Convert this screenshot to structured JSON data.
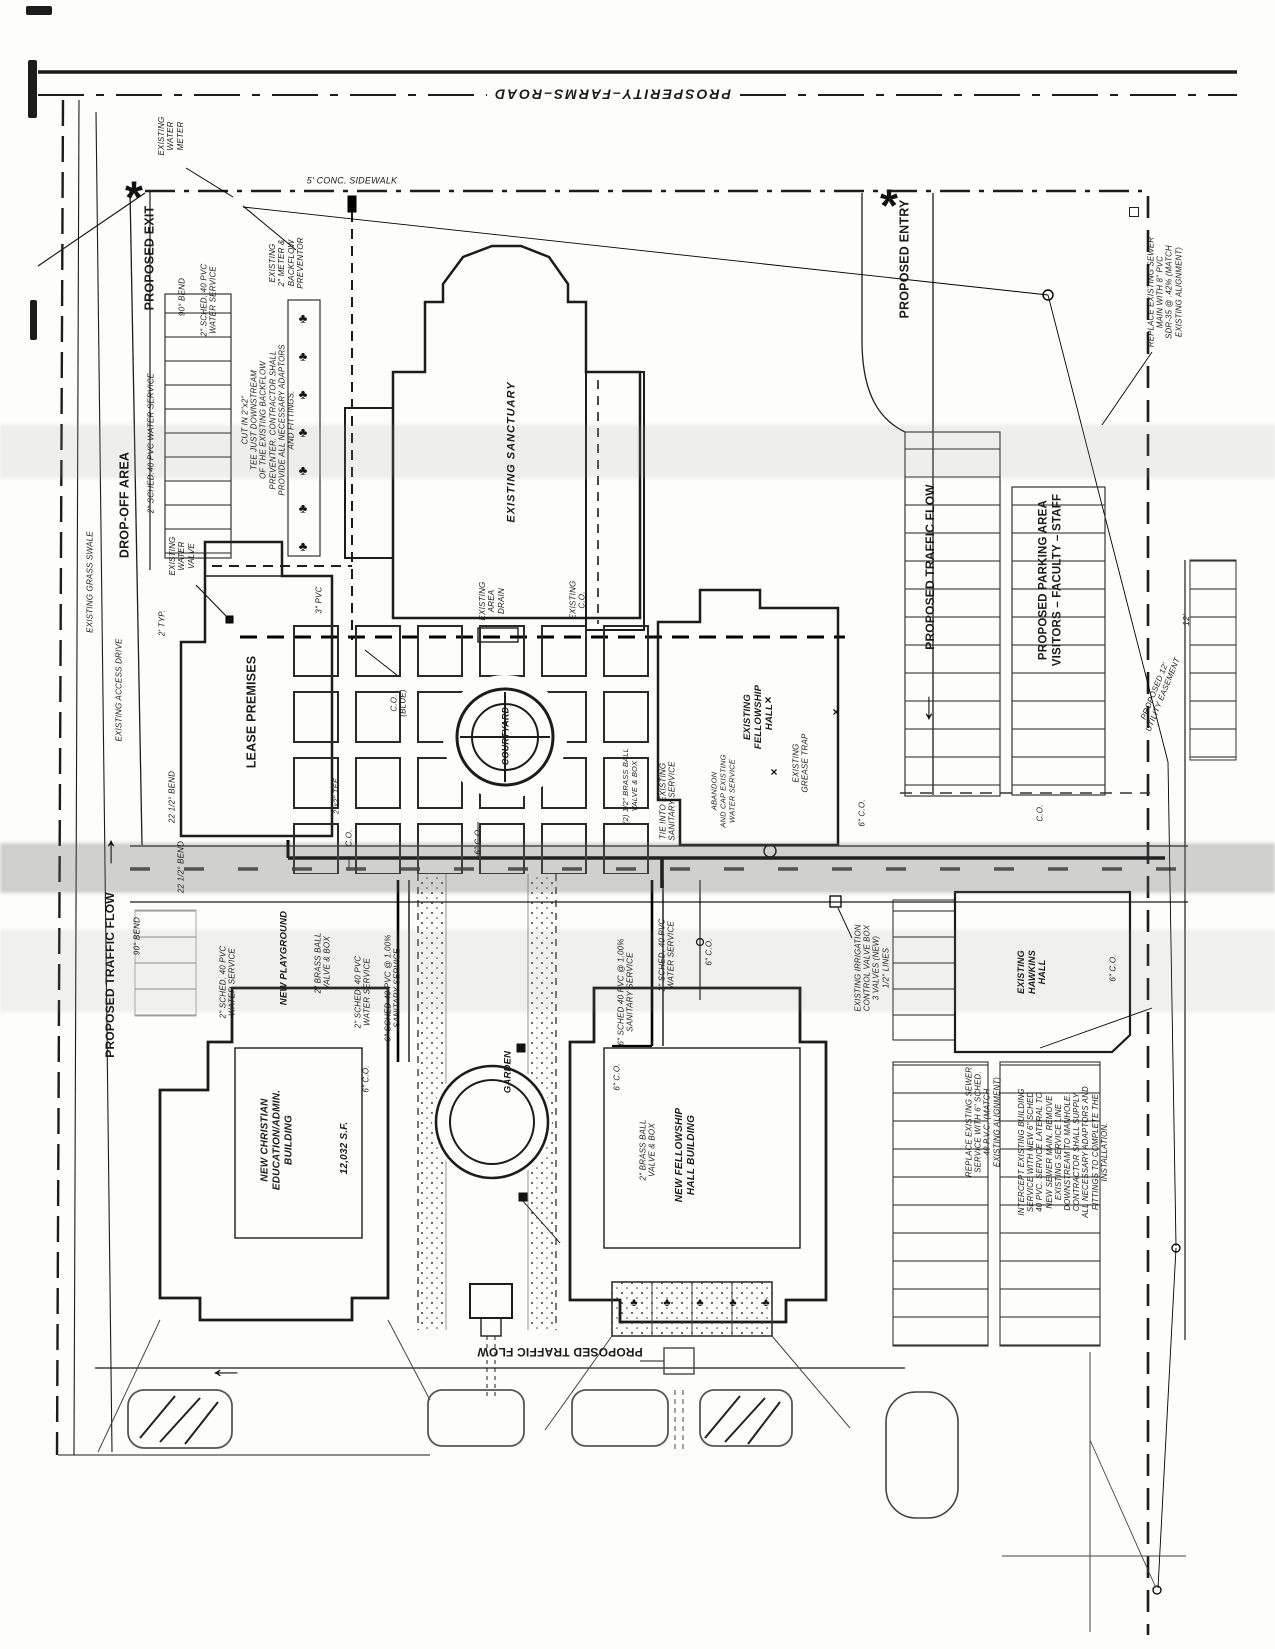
{
  "page": {
    "background": "#fdfdfb",
    "ink": "#1c1c1c",
    "faint_line": "#6b6b6b"
  },
  "road": {
    "name": "PROSPERITY–FARMS–ROAD"
  },
  "labels": [
    {
      "n": "road-name",
      "t": "PROSPERITY–FARMS–ROAD",
      "x": 612,
      "y": 94,
      "r": 180,
      "s": 14,
      "b": 1,
      "i": 1,
      "ls": 2,
      "bg": 1
    },
    {
      "n": "sidewalk-label",
      "t": "5' CONC. SIDEWALK",
      "x": 352,
      "y": 181,
      "r": 0,
      "s": 9,
      "i": 1
    },
    {
      "n": "existing-water-meter-label",
      "t": "EXISTING\nWATER\nMETER",
      "x": 171,
      "y": 136,
      "r": -90,
      "s": 8,
      "i": 1
    },
    {
      "n": "proposed-exit-label",
      "t": "PROPOSED EXIT",
      "x": 150,
      "y": 258,
      "r": -90,
      "s": 12.5,
      "b": 1
    },
    {
      "n": "bend-90-label-top",
      "t": "90° BEND",
      "x": 182,
      "y": 297,
      "r": -90,
      "s": 8,
      "i": 1
    },
    {
      "n": "water-service-label-top",
      "t": "2\" SCHED. 40 PVC\nWATER SERVICE",
      "x": 209,
      "y": 300,
      "r": -90,
      "s": 8,
      "i": 1
    },
    {
      "n": "meter-backflow-label",
      "t": "EXISTING\n2\" METER &\nBACKFLOW\nPREVENTOR",
      "x": 287,
      "y": 263,
      "r": -90,
      "s": 8,
      "i": 1
    },
    {
      "n": "note-cut-in-tee",
      "t": "CUT IN 2\"x2\"\nTEE JUST DOWNSTREAM\nOF THE EXISTING BACKFLOW\nPREVENTER. CONTRACTOR SHALL\nPROVIDE ALL NECESSARY ADAPTORS\nAND FITTINGS.",
      "x": 268,
      "y": 420,
      "r": -90,
      "s": 7.8,
      "i": 1
    },
    {
      "n": "existing-sanctuary-label",
      "t": "EXISTING SANCTUARY",
      "x": 512,
      "y": 452,
      "r": -90,
      "s": 11,
      "b": 1,
      "i": 1,
      "ls": 1
    },
    {
      "n": "existing-area-drain-label",
      "t": "EXISTING\nAREA\nDRAIN",
      "x": 492,
      "y": 601,
      "r": -90,
      "s": 8,
      "i": 1
    },
    {
      "n": "existing-co-label",
      "t": "EXISTING\nC.O.",
      "x": 578,
      "y": 600,
      "r": -90,
      "s": 8,
      "i": 1
    },
    {
      "n": "drop-off-area-label",
      "t": "DROP-OFF AREA",
      "x": 125,
      "y": 505,
      "r": -90,
      "s": 12.5,
      "b": 1
    },
    {
      "n": "water-service-label-left",
      "t": "2\" SCHED.40 PVC WATER SERVICE",
      "x": 151,
      "y": 443,
      "r": -90,
      "s": 8,
      "i": 1
    },
    {
      "n": "existing-grass-swale-label",
      "t": "EXISTING GRASS SWALE",
      "x": 90,
      "y": 582,
      "r": -90,
      "s": 8,
      "i": 1
    },
    {
      "n": "existing-access-drive-label",
      "t": "EXISTING ACCESS DRIVE",
      "x": 119,
      "y": 690,
      "r": -90,
      "s": 8,
      "i": 1
    },
    {
      "n": "existing-water-valve-label",
      "t": "EXISTING\nWATER\nVALVE",
      "x": 182,
      "y": 556,
      "r": -90,
      "s": 8,
      "i": 1
    },
    {
      "n": "typ-dim-label",
      "t": "2' TYP.",
      "x": 162,
      "y": 623,
      "r": -90,
      "s": 8,
      "i": 1
    },
    {
      "n": "lease-premises-label",
      "t": "LEASE PREMISES",
      "x": 252,
      "y": 712,
      "r": -90,
      "s": 12.5,
      "b": 1
    },
    {
      "n": "pvc-3in-label",
      "t": "3\" PVC",
      "x": 319,
      "y": 600,
      "r": -90,
      "s": 8,
      "i": 1
    },
    {
      "n": "bend-22-label-mid",
      "t": "22 1/2° BEND",
      "x": 172,
      "y": 797,
      "r": -90,
      "s": 8,
      "i": 1
    },
    {
      "n": "co-blue-label",
      "t": "C.O.\n(BLUE)",
      "x": 399,
      "y": 703,
      "r": -90,
      "s": 8,
      "i": 1
    },
    {
      "n": "courtyard-label",
      "t": "COURTYARD",
      "x": 506,
      "y": 736,
      "r": -90,
      "s": 9,
      "b": 1,
      "i": 1
    },
    {
      "n": "co-label-a",
      "t": "C.O.",
      "x": 349,
      "y": 838,
      "r": -90,
      "s": 8,
      "i": 1
    },
    {
      "n": "tee-label",
      "t": "2\"x2\" TEE",
      "x": 337,
      "y": 796,
      "r": -90,
      "s": 7.5,
      "i": 1
    },
    {
      "n": "co-6-label-courtyard",
      "t": "6\" C.O.",
      "x": 478,
      "y": 841,
      "r": -90,
      "s": 8,
      "i": 1
    },
    {
      "n": "brass-ball-half-label",
      "t": "(2) 1/2\" BRASS BALL\nVALVE & BOX",
      "x": 631,
      "y": 786,
      "r": -90,
      "s": 7.5,
      "i": 1
    },
    {
      "n": "tie-into-label",
      "t": "TIE INTO EXISTING\nSANITARY SERVICE",
      "x": 668,
      "y": 801,
      "r": -90,
      "s": 8,
      "i": 1
    },
    {
      "n": "abandon-cap-label",
      "t": "ABANDON\nAND CAP EXISTING\nWATER SERVICE",
      "x": 724,
      "y": 791,
      "r": -90,
      "s": 7.5,
      "i": 1
    },
    {
      "n": "existing-fellowship-label",
      "t": "EXISTING\nFELLOWSHIP\nHALL",
      "x": 759,
      "y": 717,
      "r": -90,
      "s": 9.5,
      "b": 1,
      "i": 1
    },
    {
      "n": "grease-trap-label",
      "t": "EXISTING\nGREASE TRAP",
      "x": 801,
      "y": 763,
      "r": -90,
      "s": 8,
      "i": 1
    },
    {
      "n": "proposed-entry-label",
      "t": "PROPOSED ENTRY",
      "x": 905,
      "y": 259,
      "r": -90,
      "s": 12.5,
      "b": 1
    },
    {
      "n": "traffic-flow-right-label",
      "t": "PROPOSED TRAFFIC FLOW",
      "x": 930,
      "y": 567,
      "r": -90,
      "s": 12,
      "b": 1
    },
    {
      "n": "parking-area-label",
      "t": "PROPOSED PARKING AREA\nVISITORS – FACULTY – STAFF",
      "x": 1051,
      "y": 580,
      "r": -90,
      "s": 11.5,
      "b": 1
    },
    {
      "n": "note-replace-sewer-main",
      "t": "REPLACE EXISTING SEWER\nMAIN WITH 8\" PVC\nSDR-35 @ .42% (MATCH\nEXISTING ALIGNMENT)",
      "x": 1165,
      "y": 292,
      "r": -90,
      "s": 7.8,
      "i": 1
    },
    {
      "n": "dim-12-label",
      "t": "12'",
      "x": 1186,
      "y": 620,
      "r": -90,
      "s": 8.5,
      "i": 1
    },
    {
      "n": "utility-easement-label",
      "t": "PROPOSED 12'\nUTILITY EASEMENT",
      "x": 1159,
      "y": 693,
      "r": -68,
      "s": 8,
      "i": 1
    },
    {
      "n": "co-6-label-b",
      "t": "6\" C.O.",
      "x": 862,
      "y": 813,
      "r": -90,
      "s": 8,
      "i": 1
    },
    {
      "n": "co-label-c",
      "t": "C.O.",
      "x": 1040,
      "y": 813,
      "r": -90,
      "s": 8,
      "i": 1
    },
    {
      "n": "bend-90-label-left",
      "t": "90° BEND",
      "x": 137,
      "y": 936,
      "r": -90,
      "s": 8,
      "i": 1
    },
    {
      "n": "traffic-flow-left-label",
      "t": "PROPOSED TRAFFIC FLOW",
      "x": 110,
      "y": 975,
      "r": -90,
      "s": 12,
      "b": 1
    },
    {
      "n": "bend-22-label-left",
      "t": "22 1/2° BEND",
      "x": 181,
      "y": 867,
      "r": -90,
      "s": 8,
      "i": 1
    },
    {
      "n": "water-service-label-a",
      "t": "2\" SCHED. 40 PVC\nWATER SERVICE",
      "x": 228,
      "y": 982,
      "r": -90,
      "s": 8,
      "i": 1
    },
    {
      "n": "new-playground-label",
      "t": "NEW PLAYGROUND",
      "x": 284,
      "y": 958,
      "r": -90,
      "s": 9.5,
      "b": 1,
      "i": 1
    },
    {
      "n": "brass-ball-label-a",
      "t": "2\" BRASS BALL\nVALVE & BOX",
      "x": 323,
      "y": 963,
      "r": -90,
      "s": 8,
      "i": 1
    },
    {
      "n": "water-service-label-b",
      "t": "2\" SCHED. 40 PVC\nWATER SERVICE",
      "x": 363,
      "y": 992,
      "r": -90,
      "s": 8,
      "i": 1
    },
    {
      "n": "sanitary-service-label-a",
      "t": "6\" SCHED 40 PVC @ 1.00%\nSANITARY SERVICE",
      "x": 393,
      "y": 988,
      "r": -90,
      "s": 8,
      "i": 1
    },
    {
      "n": "co-6-label-c",
      "t": "6\" C.O.",
      "x": 366,
      "y": 1079,
      "r": -90,
      "s": 8,
      "i": 1
    },
    {
      "n": "christian-ed-label",
      "t": "NEW CHRISTIAN\nEDUCATION/ADMIN.\nBUILDING",
      "x": 277,
      "y": 1140,
      "r": -90,
      "s": 10,
      "b": 1,
      "i": 1
    },
    {
      "n": "sqft-label",
      "t": "12,032 S.F.",
      "x": 345,
      "y": 1148,
      "r": -90,
      "s": 10,
      "b": 1,
      "i": 1
    },
    {
      "n": "garden-label",
      "t": "GARDEN",
      "x": 508,
      "y": 1072,
      "r": -90,
      "s": 9.5,
      "b": 1,
      "i": 1
    },
    {
      "n": "sanitary-service-label-b",
      "t": "6\" SCHED 40 PVC @ 1.00%\nSANITARY SERVICE",
      "x": 626,
      "y": 992,
      "r": -90,
      "s": 8,
      "i": 1
    },
    {
      "n": "water-service-label-c",
      "t": "2\" SCHED. 40 PVC\nWATER SERVICE",
      "x": 667,
      "y": 955,
      "r": -90,
      "s": 8,
      "i": 1
    },
    {
      "n": "co-6-label-d",
      "t": "6\" C.O.",
      "x": 709,
      "y": 952,
      "r": -90,
      "s": 8,
      "i": 1
    },
    {
      "n": "co-6-label-e",
      "t": "6\" C.O.",
      "x": 617,
      "y": 1077,
      "r": -90,
      "s": 8,
      "i": 1
    },
    {
      "n": "brass-ball-label-b",
      "t": "2\" BRASS BALL\nVALVE & BOX",
      "x": 648,
      "y": 1150,
      "r": -90,
      "s": 8,
      "i": 1
    },
    {
      "n": "new-fellowship-label",
      "t": "NEW FELLOWSHIP\nHALL BUILDING",
      "x": 686,
      "y": 1155,
      "r": -90,
      "s": 10,
      "b": 1,
      "i": 1
    },
    {
      "n": "irrigation-label",
      "t": "EXISTING IRRIGATION\nCONTROL VALVE BOX\n3 VALVES (NEW)\n1/2\" LINES",
      "x": 872,
      "y": 968,
      "r": -90,
      "s": 7.8,
      "i": 1
    },
    {
      "n": "hawkins-hall-label",
      "t": "EXISTING\nHAWKINS\nHALL",
      "x": 1032,
      "y": 972,
      "r": -90,
      "s": 9,
      "b": 1,
      "i": 1
    },
    {
      "n": "co-6-label-f",
      "t": "6\" C.O.",
      "x": 1113,
      "y": 968,
      "r": -90,
      "s": 8,
      "i": 1
    },
    {
      "n": "note-replace-sewer-service",
      "t": "REPLACE EXISTING SEWER\nSERVICE WITH 6\" SCHED.\n40 P.V.C. (MATCH\nEXISTING ALIGNMENT)",
      "x": 983,
      "y": 1122,
      "r": -90,
      "s": 7.8,
      "i": 1
    },
    {
      "n": "note-intercept",
      "t": "INTERCEPT EXISTING BUILDING\nSERVICE WITH NEW 6\" SCHED\n40 PVC. SERVICE LATERAL TO\nNEW SEWER MAIN. REMOVE\nEXISTING SERVICE LINE\nDOWNSTREAM TO MANHOLE.\nCONTRACTOR SHALL SUPPLY\nALL NECESSARY ADAPTORS AND\nFITTINGS TO COMPLETE THE\nINSTALLATION.",
      "x": 1063,
      "y": 1152,
      "r": -90,
      "s": 7.8,
      "i": 1
    },
    {
      "n": "traffic-flow-bottom-label",
      "t": "PROPOSED TRAFFIC FLOW",
      "x": 560,
      "y": 1352,
      "r": 180,
      "s": 12,
      "b": 1
    }
  ],
  "markers": [
    {
      "k": "asterisk",
      "n": "asterisk-marker-west",
      "t": "*",
      "x": 134,
      "y": 198,
      "r": 0,
      "s": 46
    },
    {
      "k": "asterisk",
      "n": "asterisk-marker-east",
      "t": "*",
      "x": 889,
      "y": 206,
      "r": 0,
      "s": 46
    },
    {
      "k": "arrow",
      "n": "traffic-arrow-south",
      "t": "→",
      "x": 933,
      "y": 708,
      "r": 90,
      "s": 26
    },
    {
      "k": "arrow",
      "n": "traffic-arrow-north",
      "t": "→",
      "x": 107,
      "y": 852,
      "r": -90,
      "s": 26
    },
    {
      "k": "arrow",
      "n": "traffic-arrow-west",
      "t": "→",
      "x": 226,
      "y": 1377,
      "r": 180,
      "s": 26
    },
    {
      "k": "tree",
      "n": "tree-symbol",
      "t": "♣",
      "x": 303,
      "y": 318,
      "r": 0,
      "s": 13
    },
    {
      "k": "tree",
      "n": "tree-symbol",
      "t": "♣",
      "x": 303,
      "y": 356,
      "r": 0,
      "s": 13
    },
    {
      "k": "tree",
      "n": "tree-symbol",
      "t": "♣",
      "x": 303,
      "y": 394,
      "r": 0,
      "s": 13
    },
    {
      "k": "tree",
      "n": "tree-symbol",
      "t": "♣",
      "x": 303,
      "y": 432,
      "r": 0,
      "s": 13
    },
    {
      "k": "tree",
      "n": "tree-symbol",
      "t": "♣",
      "x": 303,
      "y": 470,
      "r": 0,
      "s": 13
    },
    {
      "k": "tree",
      "n": "tree-symbol",
      "t": "♣",
      "x": 303,
      "y": 508,
      "r": 0,
      "s": 13
    },
    {
      "k": "tree",
      "n": "tree-symbol",
      "t": "♣",
      "x": 303,
      "y": 546,
      "r": 0,
      "s": 13
    },
    {
      "k": "tree",
      "n": "tree-symbol",
      "t": "♣",
      "x": 634,
      "y": 1303,
      "r": 0,
      "s": 11
    },
    {
      "k": "tree",
      "n": "tree-symbol",
      "t": "♣",
      "x": 667,
      "y": 1303,
      "r": 0,
      "s": 11
    },
    {
      "k": "tree",
      "n": "tree-symbol",
      "t": "♣",
      "x": 700,
      "y": 1303,
      "r": 0,
      "s": 11
    },
    {
      "k": "tree",
      "n": "tree-symbol",
      "t": "♣",
      "x": 733,
      "y": 1303,
      "r": 0,
      "s": 11
    },
    {
      "k": "tree",
      "n": "tree-symbol",
      "t": "♣",
      "x": 766,
      "y": 1303,
      "r": 0,
      "s": 11
    },
    {
      "k": "xmark",
      "n": "x-mark",
      "t": "×",
      "x": 768,
      "y": 700,
      "r": 0,
      "s": 12
    },
    {
      "k": "xmark",
      "n": "x-mark",
      "t": "×",
      "x": 836,
      "y": 712,
      "r": 0,
      "s": 12
    },
    {
      "k": "xmark",
      "n": "x-mark",
      "t": "×",
      "x": 774,
      "y": 772,
      "r": 0,
      "s": 12
    },
    {
      "k": "square",
      "n": "valve-box-marker",
      "x": 521,
      "y": 1048,
      "s": 9
    },
    {
      "k": "square",
      "n": "valve-box-marker",
      "x": 523,
      "y": 1197,
      "s": 9
    },
    {
      "k": "sqo",
      "n": "box-symbol",
      "x": 1134,
      "y": 212,
      "s": 8
    }
  ]
}
